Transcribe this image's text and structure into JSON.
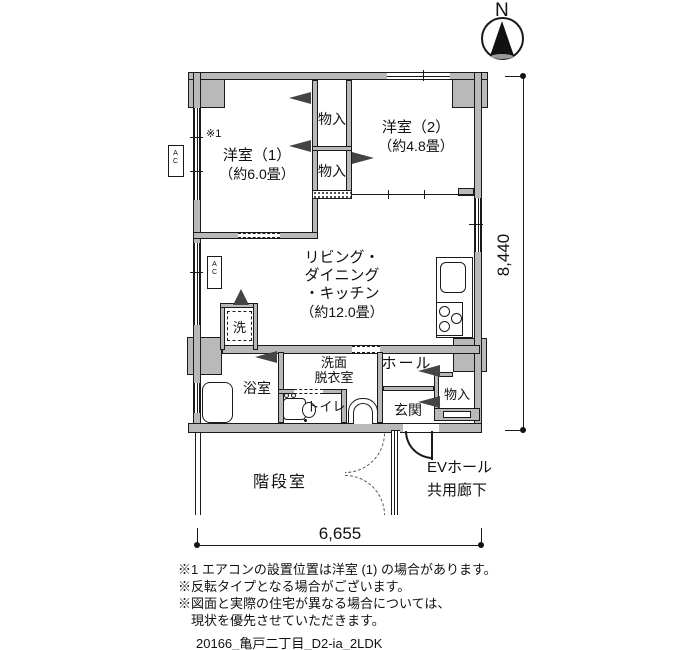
{
  "compass": {
    "label": "N"
  },
  "rooms": {
    "bed1": {
      "name": "洋室（1）",
      "area": "（約6.0畳）"
    },
    "bed2": {
      "name": "洋室（2）",
      "area": "（約4.8畳）"
    },
    "closet1": {
      "name": "物入"
    },
    "closet2": {
      "name": "物入"
    },
    "ldk": {
      "line1": "リビング・",
      "line2": "ダイニング",
      "line3": "・キッチン",
      "area": "（約12.0畳）"
    },
    "washroom": {
      "line1": "洗面",
      "line2": "脱衣室"
    },
    "bath": {
      "name": "浴室"
    },
    "toilet": {
      "name": "トイレ"
    },
    "hall": {
      "name": "ホール"
    },
    "entry": {
      "name": "玄関"
    },
    "closet3": {
      "name": "物入"
    },
    "stairwell": {
      "name": "階段室"
    },
    "ev_hall": {
      "line1": "EVホール",
      "line2": "共用廊下"
    },
    "laundry": {
      "name": "洗"
    },
    "ac1": {
      "name": "AC"
    },
    "ac2": {
      "name": "AC"
    },
    "note_marker": "※1"
  },
  "dimensions": {
    "vertical": "8,440",
    "horizontal": "6,655"
  },
  "notes": {
    "line1": "※1 エアコンの設置位置は洋室 (1) の場合があります。",
    "line2": "※反転タイプとなる場合がございます。",
    "line3": "※図面と実際の住宅が異なる場合については、",
    "line4": "現状を優先させていただきます。"
  },
  "footer": {
    "file_label": "20166_亀戸二丁目_D2-ia_2LDK"
  },
  "colors": {
    "wall_fill": "#b9b9b9",
    "line": "#1a1a1a",
    "background": "#ffffff"
  }
}
